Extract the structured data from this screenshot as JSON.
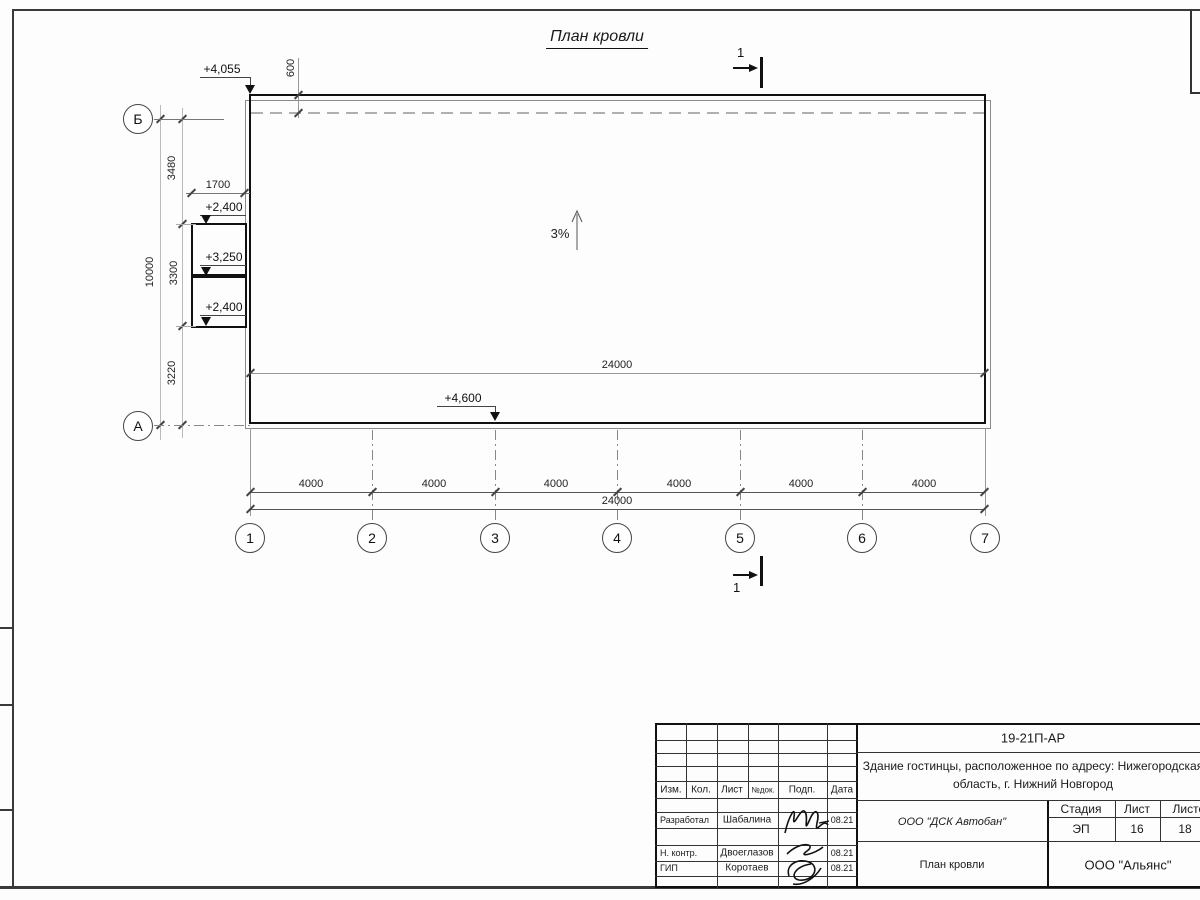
{
  "title": "План кровли",
  "colors": {
    "ink": "#1a1a1a",
    "dim_lines": "#777777",
    "hidden_line": "#b0b0b0"
  },
  "drawing": {
    "slope_label": "3%",
    "section_mark": "1",
    "elevations": {
      "top_left": "+4,055",
      "annex_top": "+2,400",
      "annex_mid": "+3,250",
      "annex_bottom": "+2,400",
      "bottom": "+4,600"
    },
    "dims": {
      "top_600": "600",
      "left_3480": "3480",
      "left_3300": "3300",
      "left_3220": "3220",
      "left_10000": "10000",
      "annex_1700": "1700",
      "span_4000": "4000",
      "total_24000": "24000"
    },
    "axes": {
      "rows": [
        "Б",
        "А"
      ],
      "cols": [
        "1",
        "2",
        "3",
        "4",
        "5",
        "6",
        "7"
      ]
    }
  },
  "titleblock": {
    "doc_number": "19-21П-АР",
    "project_line1": "Здание гостинцы, расположенное по адресу: Нижегородская",
    "project_line2": "область, г. Нижний Новгород",
    "header_cells": [
      "Изм.",
      "Кол.",
      "Лист",
      "№док.",
      "Подп.",
      "Дата"
    ],
    "staff": [
      {
        "role": "Разработал",
        "name": "Шабалина",
        "date": "08.21"
      },
      {
        "role": "Н. контр.",
        "name": "Двоеглазов",
        "date": "08.21"
      },
      {
        "role": "ГИП",
        "name": "Коротаев",
        "date": "08.21"
      }
    ],
    "contractor": "ООО \"ДСК Автобан\"",
    "stage_header": [
      "Стадия",
      "Лист",
      "Листов"
    ],
    "stage_values": [
      "ЭП",
      "16",
      "18"
    ],
    "sheet_name": "План кровли",
    "company": "ООО \"Альянс\""
  }
}
